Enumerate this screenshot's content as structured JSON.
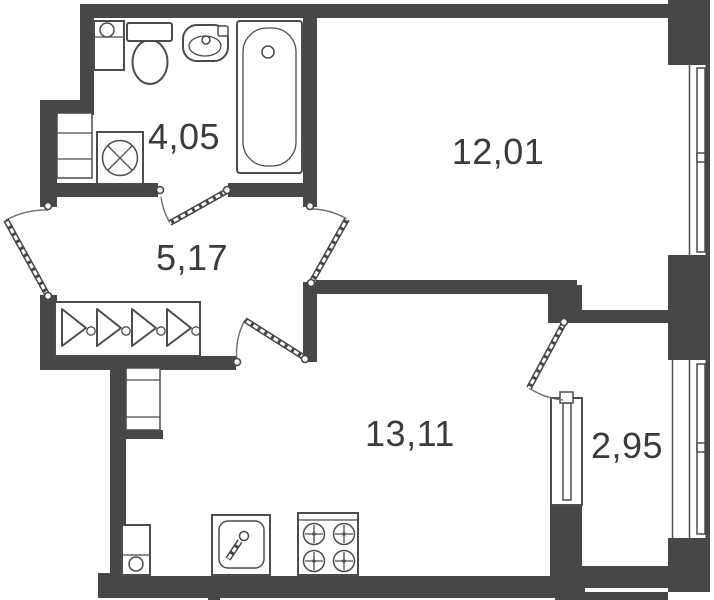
{
  "plan_title": "apartment-floor-plan",
  "colors": {
    "wall": "#474747",
    "line": "#4c4c4c",
    "text": "#3b3b3b",
    "background": "#ffffff"
  },
  "rooms": {
    "bathroom": {
      "area_label": "4,05",
      "fixtures": [
        "utility-sink-icon",
        "toilet-icon",
        "washbasin-icon",
        "bathtub-icon",
        "washing-machine-icon",
        "vent-shaft-icon"
      ]
    },
    "living_room": {
      "area_label": "12,01",
      "fixtures": [
        "window-icon",
        "door-swing-icon"
      ]
    },
    "hallway": {
      "area_label": "5,17",
      "fixtures": [
        "wardrobe-hangers-icon",
        "entrance-door-swing-icon"
      ]
    },
    "kitchen": {
      "area_label": "13,11",
      "fixtures": [
        "fridge-icon",
        "kitchen-sink-icon",
        "stove-icon",
        "vent-shaft-icon",
        "balcony-door-swing-icon"
      ]
    },
    "balcony": {
      "area_label": "2,95",
      "fixtures": [
        "window-icon"
      ]
    }
  }
}
